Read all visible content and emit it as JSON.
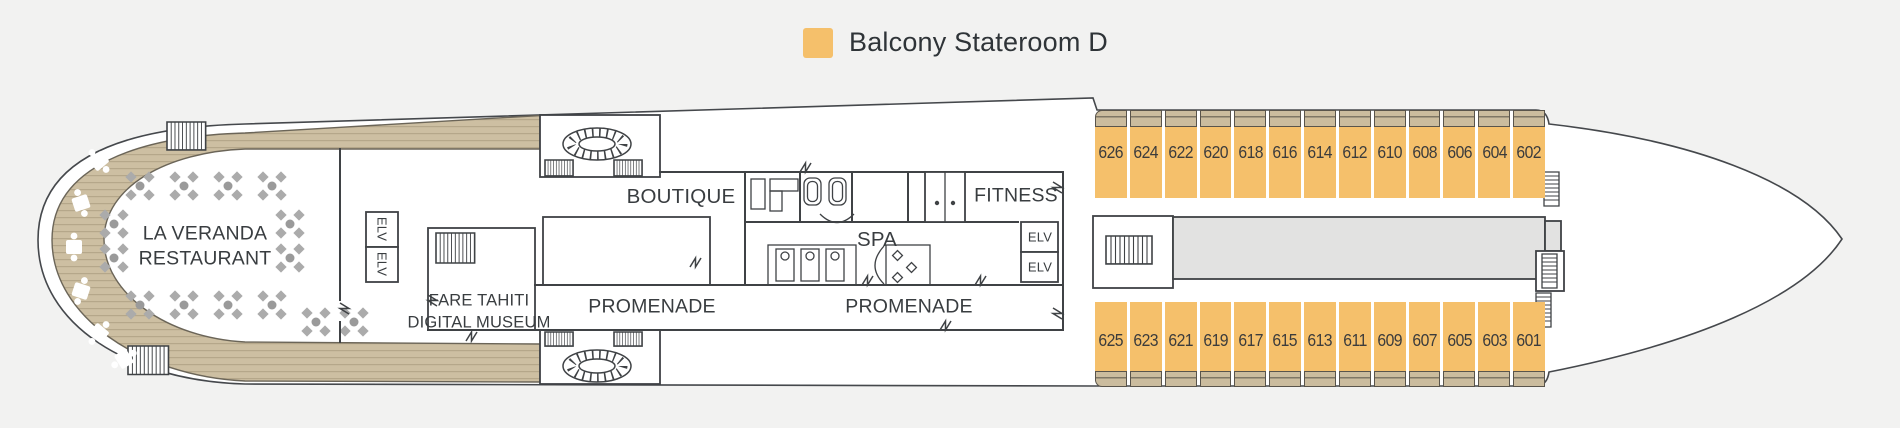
{
  "legend": {
    "swatch_color": "#F5C06B",
    "label": "Balcony Stateroom D"
  },
  "rooms": {
    "la_veranda_line1": "LA VERANDA",
    "la_veranda_line2": "RESTAURANT",
    "fare_tahiti_line1": "FARE TAHITI",
    "fare_tahiti_line2": "DIGITAL MUSEUM",
    "boutique": "BOUTIQUE",
    "promenade_left": "PROMENADE",
    "promenade_right": "PROMENADE",
    "spa": "SPA",
    "fitness": "FITNESS",
    "elevator": "ELV"
  },
  "staterooms": {
    "category": "Balcony Stateroom D",
    "top_row": [
      "626",
      "624",
      "622",
      "620",
      "618",
      "616",
      "614",
      "612",
      "610",
      "608",
      "606",
      "604",
      "602"
    ],
    "bottom_row": [
      "625",
      "623",
      "621",
      "619",
      "617",
      "615",
      "613",
      "611",
      "609",
      "607",
      "605",
      "603",
      "601"
    ]
  },
  "colors": {
    "bg": "#F2F2F1",
    "cabin": "#F5C06B",
    "balcony": "#CBBC9E",
    "wood": "#CDBFA2",
    "woodline": "#B5A78A",
    "corridor": "#E2E2E1",
    "wall": "#3F4245",
    "text": "#393D40"
  }
}
